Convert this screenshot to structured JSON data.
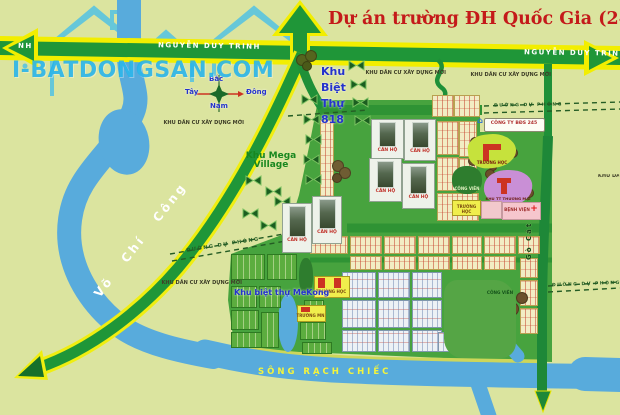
{
  "title": "Dự án trường ĐH Quốc Gia (245)",
  "watermark": "I-BATDONGSAN.COM",
  "compass": {
    "north": "Bắc",
    "south": "Nam",
    "east": "Đông",
    "west": "Tây"
  },
  "roads": {
    "nguyen_duy_trinh": "NGUYỄN DUY TRINH",
    "nguyen_duy_trinh_fragment": "NH",
    "vo_chi_cong": "Võ Chí Công",
    "go_cat": "Gò Cát",
    "planned_road": "ĐƯỜNG DỰ PHÓNG",
    "river": "SÔNG RẠCH CHIẾC"
  },
  "labels": {
    "new_residential": "KHU DÂN CƯ XÂY DỰNG MỚI",
    "mega_village_line1": "Khu Mega",
    "mega_village_line2": "Village",
    "villa_818": [
      "Khu",
      "Biệt",
      "Thự",
      "818"
    ],
    "mekong": "Khu biệt thự MeKong",
    "apartment": "CĂN HỘ",
    "school": "TRƯỜNG HỌC",
    "kindergarten": "TRƯỜNG MN",
    "park": "CÔNG VIÊN",
    "trade_center": "KHU TT THƯƠNG MẠI",
    "hospital": "BỆNH VIỆN",
    "company": "CÔNG TY BĐS 245"
  },
  "colors": {
    "title_red": "#c41a1a",
    "road_yellow": "#f2ee00",
    "road_green": "#1f9638",
    "project_green": "#47a33e",
    "river_blue": "#58abdc",
    "watermark_blue": "#23b2e8",
    "background": "#dbe49f"
  }
}
